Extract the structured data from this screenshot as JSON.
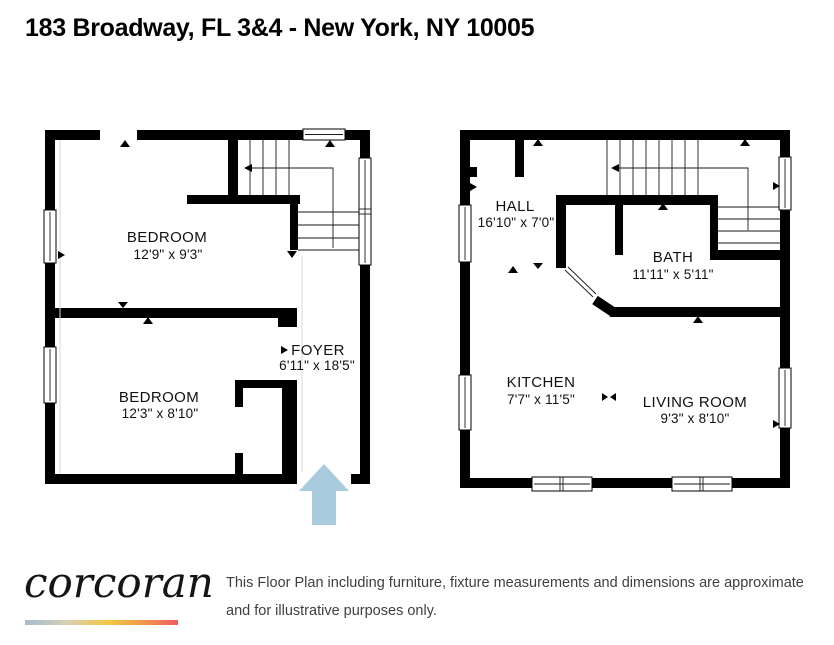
{
  "title": "183 Broadway, FL 3&4 - New York, NY 10005",
  "plans": {
    "left": {
      "bedroom1": {
        "label": "BEDROOM",
        "dims": "12'9\" x 9'3\""
      },
      "bedroom2": {
        "label": "BEDROOM",
        "dims": "12'3\" x 8'10\""
      },
      "foyer": {
        "label": "FOYER",
        "dims": "6'11\" x 18'5\""
      }
    },
    "right": {
      "hall": {
        "label": "HALL",
        "dims": "16'10\" x 7'0\""
      },
      "bath": {
        "label": "BATH",
        "dims": "11'11\" x 5'11\""
      },
      "kitchen": {
        "label": "KITCHEN",
        "dims": "7'7\" x 11'5\""
      },
      "living_room": {
        "label": "LIVING ROOM",
        "dims": "9'3\" x 8'10\""
      }
    }
  },
  "footer": {
    "brand": "corcoran",
    "disclaimer": "This Floor Plan including furniture, fixture measurements and dimensions are approximate and for illustrative purposes only."
  },
  "colors": {
    "wall": "#000000",
    "entry_arrow": "#a9cbdd",
    "logo_gradient": [
      "#a3bccf",
      "#d9d0b4",
      "#f4c642",
      "#f0914d",
      "#ee5a64"
    ]
  }
}
